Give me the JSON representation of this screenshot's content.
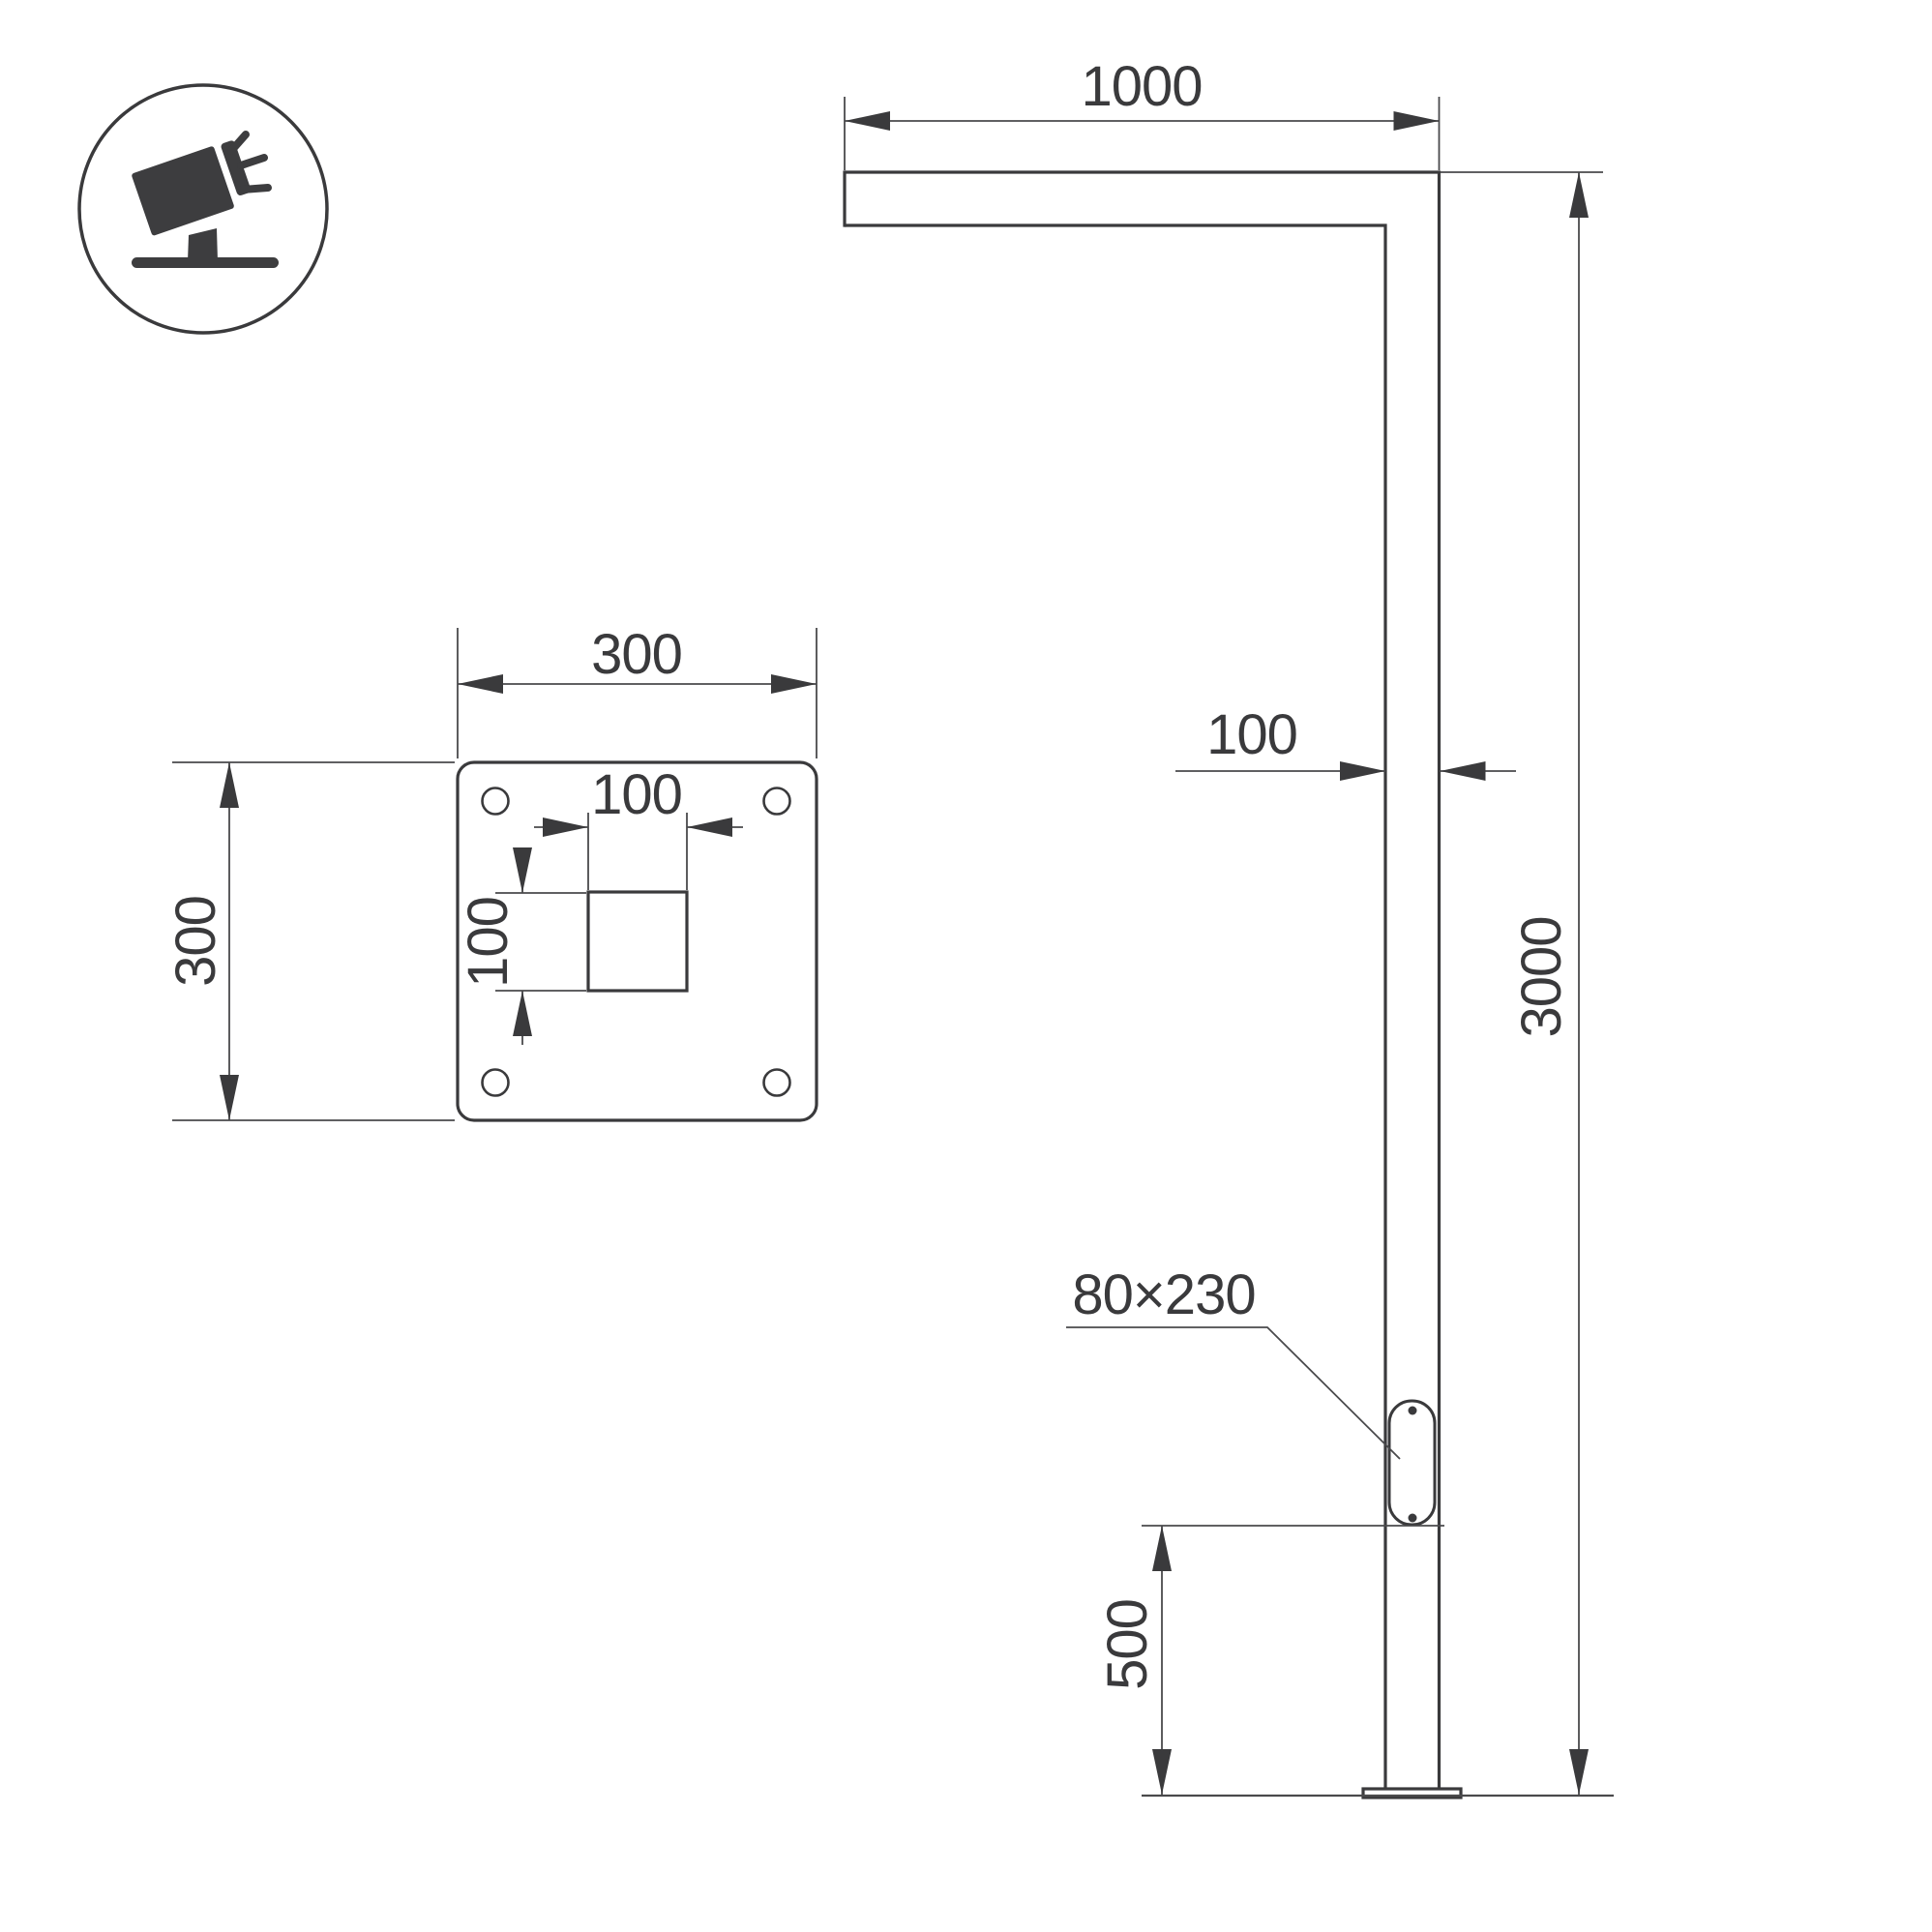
{
  "page": {
    "background": "#ffffff",
    "line_color": "#3a3a3c"
  },
  "icon": {
    "meaning": "tilted-floodlight-on-stand"
  },
  "pole_view": {
    "dim_arm_length": "1000",
    "dim_pole_width": "100",
    "dim_pole_height": "3000",
    "door_label": "80×230",
    "dim_door_height_from_base": "500"
  },
  "base_plate_view": {
    "dim_plate_width": "300",
    "dim_plate_height": "300",
    "dim_inner_square_width": "100",
    "dim_inner_square_height": "100"
  }
}
